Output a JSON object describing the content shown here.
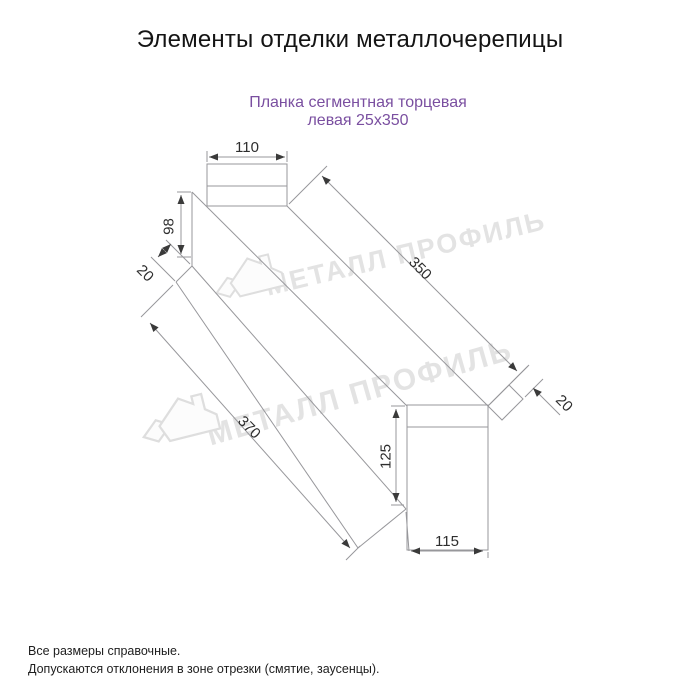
{
  "title": "Элементы отделки металлочерепицы",
  "subtitle": {
    "line1": "Планка сегментная торцевая",
    "line2": "левая 25х350",
    "color": "#7a4fa0"
  },
  "dims": {
    "width_top": "110",
    "height_left": "98",
    "hem_left": "20",
    "length_top": "350",
    "length_bottom": "370",
    "hem_right": "20",
    "height_right": "125",
    "width_bottom": "115"
  },
  "watermark": {
    "text": "МЕТАЛЛ ПРОФИЛЬ",
    "color": "#e3e3e3"
  },
  "footer": {
    "line1": "Все размеры справочные.",
    "line2": "Допускаются отклонения в зоне отрезки (смятие, заусенцы)."
  },
  "drawing": {
    "line_color": "#97979b",
    "arrow_color": "#3a3a3a"
  }
}
